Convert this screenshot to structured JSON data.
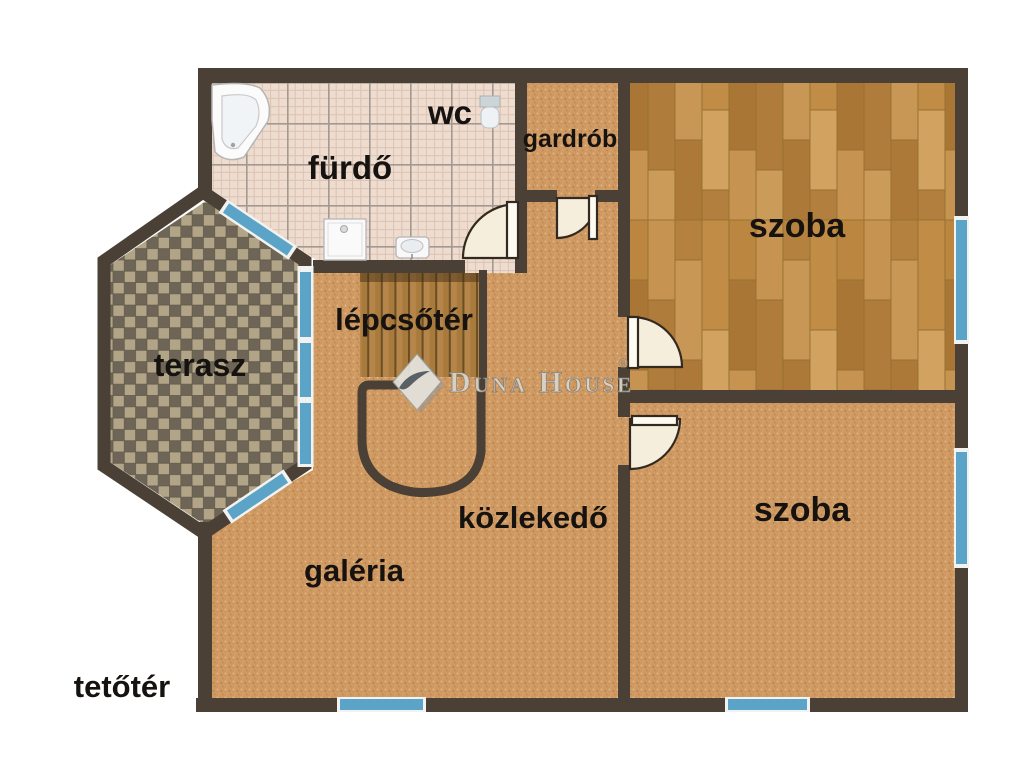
{
  "plan": {
    "labels": {
      "furdo": "fürdő",
      "wc": "wc",
      "gardrob": "gardrób",
      "szoba_top": "szoba",
      "lepcsoter": "lépcsőtér",
      "terasz": "terasz",
      "kozlekedo": "közlekedő",
      "galeria": "galéria",
      "szoba_bottom": "szoba",
      "tetoter": "tetőtér"
    },
    "watermark": {
      "brand": "Duna House",
      "registered": "®"
    },
    "colors": {
      "wall": "#4b4036",
      "window_blue": "#5ba4c7",
      "window_frame": "#f2f2f0",
      "carpet": "#cf9a63",
      "parquet": "#bf8c49",
      "bath_tile": "#eedccf",
      "terrace_dark": "#6e6556",
      "terrace_light": "#b1a487",
      "stair_wood": "#a87a3c",
      "door_fill": "#f6eedd",
      "label_text": "#151210"
    }
  }
}
